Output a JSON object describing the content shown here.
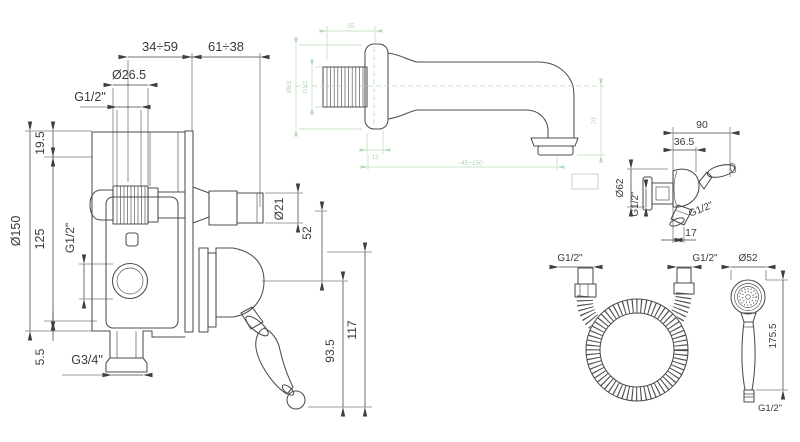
{
  "palette": {
    "background": "#ffffff",
    "line": "#4d4d4d",
    "dimension_text": "#3a3a3a",
    "faint_green": "#b7dcb7"
  },
  "views": {
    "mixer": {
      "dims": {
        "depth1": "34÷59",
        "depth2": "61÷38",
        "cap_dia": "Ø26.5",
        "top_thread": "G1/2\"",
        "top_offset": "19.5",
        "plate_dia": "Ø150",
        "center_height": "125",
        "side_thread": "G1/2\"",
        "bottom_offset": "5.5",
        "bottom_thread": "G3/4\"",
        "stem_dia": "Ø21",
        "spacing": "52",
        "lever_drop": "93.5",
        "total_drop": "117"
      }
    },
    "spout": {
      "dims": {
        "top_len": "55",
        "flange_dia": "Ø63",
        "inlet_thread": "G1/2",
        "flange_depth": "12",
        "reach": "~45÷150",
        "drop": "70"
      }
    },
    "holder": {
      "dims": {
        "width": "90",
        "depth": "36.5",
        "flange_dia": "Ø62",
        "wall_thread": "G1/2\"",
        "outlet_thread": "G1/2\"",
        "outlet_offset": "17"
      }
    },
    "hose": {
      "dims": {
        "left_thread": "G1/2\"",
        "right_thread": "G1/2\""
      }
    },
    "handshower": {
      "dims": {
        "head_dia": "Ø52",
        "length": "175.5",
        "thread": "G1/2\""
      }
    }
  }
}
